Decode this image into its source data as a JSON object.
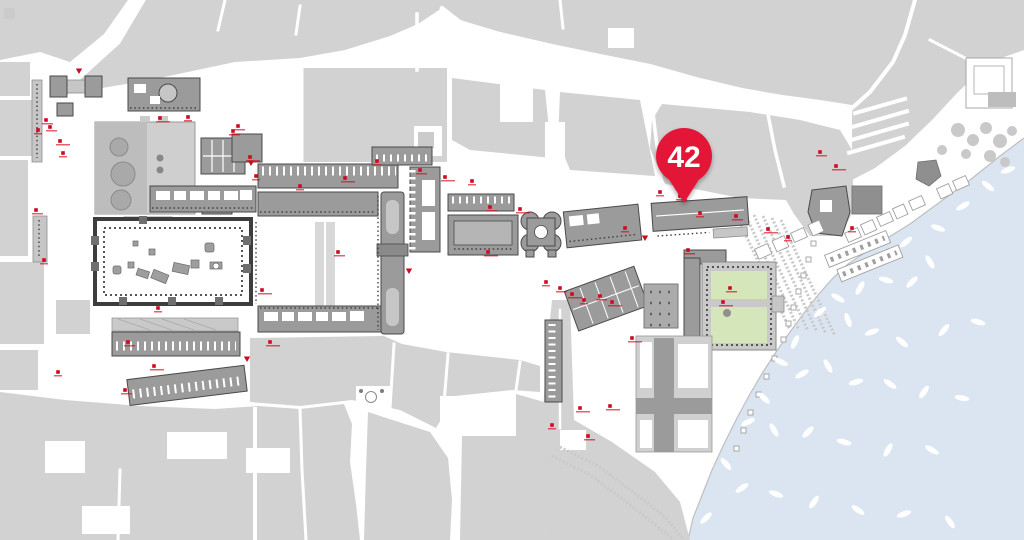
{
  "map": {
    "pin": {
      "label": "42",
      "x": 684,
      "y": 156,
      "color": "#e31837",
      "text_color": "#ffffff"
    },
    "palette": {
      "block": "#d2d2d2",
      "building": "#9b9b9b",
      "outline": "#4a4a4a",
      "water": "#dbe5f1",
      "lawn": "#d6e6bb",
      "accent": "#cf0a1e",
      "boat": "#ffffff"
    },
    "markers": {
      "squares": [
        [
          38,
          130
        ],
        [
          50,
          127
        ],
        [
          60,
          141
        ],
        [
          63,
          153
        ],
        [
          46,
          120
        ],
        [
          160,
          118
        ],
        [
          188,
          117
        ],
        [
          238,
          126
        ],
        [
          250,
          157
        ],
        [
          256,
          176
        ],
        [
          233,
          131
        ],
        [
          345,
          178
        ],
        [
          377,
          161
        ],
        [
          420,
          170
        ],
        [
          445,
          177
        ],
        [
          472,
          181
        ],
        [
          490,
          207
        ],
        [
          520,
          209
        ],
        [
          300,
          186
        ],
        [
          338,
          252
        ],
        [
          262,
          290
        ],
        [
          158,
          308
        ],
        [
          128,
          342
        ],
        [
          154,
          366
        ],
        [
          58,
          372
        ],
        [
          125,
          390
        ],
        [
          270,
          342
        ],
        [
          44,
          260
        ],
        [
          36,
          210
        ],
        [
          488,
          252
        ],
        [
          546,
          282
        ],
        [
          560,
          288
        ],
        [
          572,
          294
        ],
        [
          584,
          300
        ],
        [
          600,
          296
        ],
        [
          612,
          302
        ],
        [
          625,
          228
        ],
        [
          688,
          250
        ],
        [
          632,
          338
        ],
        [
          700,
          213
        ],
        [
          736,
          216
        ],
        [
          768,
          229
        ],
        [
          788,
          237
        ],
        [
          820,
          152
        ],
        [
          836,
          166
        ],
        [
          852,
          228
        ],
        [
          730,
          288
        ],
        [
          580,
          408
        ],
        [
          552,
          425
        ],
        [
          588,
          436
        ],
        [
          610,
          406
        ],
        [
          660,
          192
        ],
        [
          680,
          196
        ],
        [
          723,
          302
        ]
      ],
      "triangles": [
        [
          79,
          71
        ],
        [
          247,
          359
        ],
        [
          251,
          163
        ],
        [
          409,
          271
        ],
        [
          645,
          238
        ]
      ]
    },
    "boats": [
      [
        906,
        242,
        -40
      ],
      [
        938,
        228,
        20
      ],
      [
        963,
        206,
        -30
      ],
      [
        988,
        186,
        40
      ],
      [
        1008,
        170,
        -20
      ],
      [
        930,
        262,
        60
      ],
      [
        912,
        282,
        -45
      ],
      [
        886,
        280,
        15
      ],
      [
        860,
        288,
        -60
      ],
      [
        838,
        298,
        30
      ],
      [
        820,
        312,
        -40
      ],
      [
        848,
        320,
        70
      ],
      [
        872,
        332,
        -20
      ],
      [
        902,
        342,
        40
      ],
      [
        944,
        330,
        -50
      ],
      [
        978,
        322,
        15
      ],
      [
        795,
        342,
        -65
      ],
      [
        781,
        362,
        25
      ],
      [
        802,
        374,
        -30
      ],
      [
        828,
        366,
        60
      ],
      [
        856,
        382,
        -15
      ],
      [
        890,
        384,
        35
      ],
      [
        924,
        392,
        -55
      ],
      [
        962,
        398,
        10
      ],
      [
        764,
        398,
        45
      ],
      [
        748,
        422,
        -25
      ],
      [
        774,
        430,
        60
      ],
      [
        808,
        432,
        -45
      ],
      [
        844,
        442,
        15
      ],
      [
        888,
        450,
        -60
      ],
      [
        932,
        450,
        30
      ],
      [
        726,
        464,
        50
      ],
      [
        742,
        488,
        -35
      ],
      [
        776,
        494,
        20
      ],
      [
        814,
        502,
        -55
      ],
      [
        858,
        510,
        35
      ],
      [
        904,
        514,
        -20
      ],
      [
        950,
        522,
        55
      ],
      [
        706,
        518,
        -45
      ]
    ]
  }
}
